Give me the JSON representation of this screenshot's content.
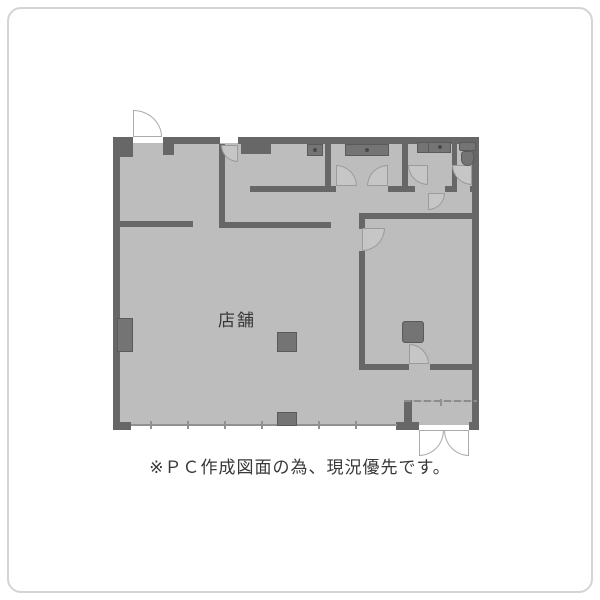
{
  "floorplan": {
    "labels": {
      "shop": "店舗"
    },
    "caption": "※ＰＣ作成図面の為、現況優先です。",
    "colors": {
      "wall": "#676767",
      "floor": "#bdbdbd",
      "fixture": "#747474",
      "door-line": "#9b9b9b",
      "door-fill-in": "#c6c6c6",
      "door-fill-out": "#ffffff",
      "frame": "#d4d4d4",
      "text": "#383838"
    },
    "fixtures": [
      "toilet",
      "vanity-sink",
      "kitchen-sink-counter",
      "stove-unit",
      "pillar",
      "pillar",
      "pillar",
      "pillar"
    ],
    "doors": [
      "back-door-exterior",
      "kitchen-top-door",
      "kitchen-double-door",
      "washroom-door",
      "corridor-door",
      "toilet-door",
      "right-room-door",
      "right-room-bottom-door",
      "entrance-double-door"
    ]
  }
}
